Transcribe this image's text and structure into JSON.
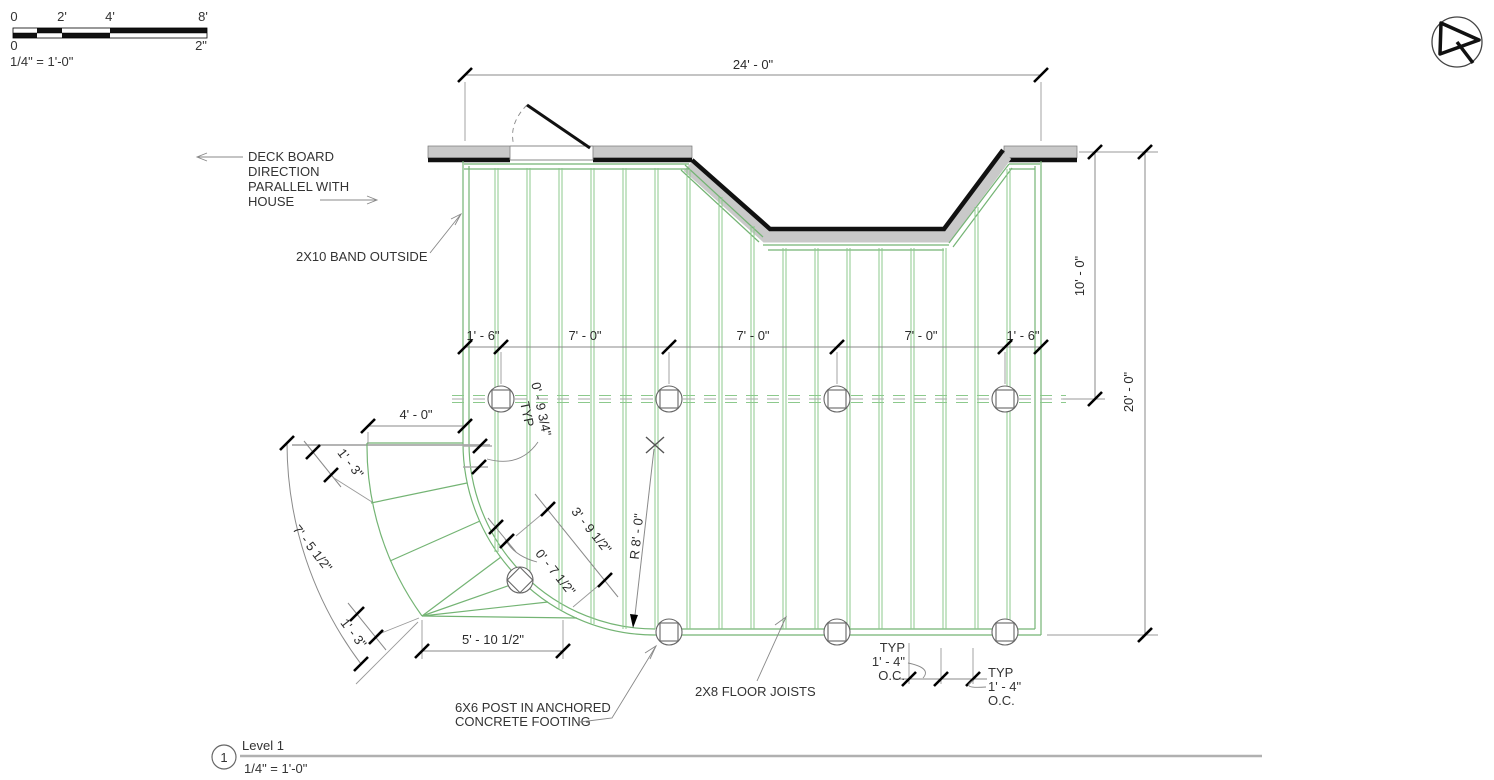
{
  "scale_bar": {
    "ticks_top": [
      "0",
      "2'",
      "4'",
      "8'"
    ],
    "ticks_bottom": [
      "0",
      "2\""
    ],
    "label": "1/4\" = 1'-0\""
  },
  "annotations": {
    "deck_board_lines": [
      "DECK BOARD",
      "DIRECTION",
      "PARALLEL WITH",
      "HOUSE"
    ],
    "band_outside": "2X10 BAND OUTSIDE",
    "post_label_lines": [
      "6X6 POST IN ANCHORED",
      "CONCRETE FOOTING"
    ],
    "floor_joists": "2X8 FLOOR JOISTS",
    "typ_oc_left": [
      "TYP",
      "1' - 4\"",
      "O.C."
    ],
    "typ_oc_right": [
      "TYP",
      "1' - 4\"",
      "O.C."
    ]
  },
  "dimensions": {
    "overall_width": "24' - 0\"",
    "depth_to_beam": "10' - 0\"",
    "overall_depth": "20' - 0\"",
    "post_string": [
      "1' - 6\"",
      "7' - 0\"",
      "7' - 0\"",
      "7' - 0\"",
      "1' - 6\""
    ],
    "stair_top_width": "4' - 0\"",
    "tread_upper": "1' - 3\"",
    "stair_arc": "7' - 5 1/2\"",
    "tread_lower": "1' - 3\"",
    "stair_bottom": "5' - 10 1/2\"",
    "stair_diag": "3' - 9 1/2\"",
    "offset_typ": "0' - 9 3/4\"",
    "offset_typ_suffix": "TYP",
    "tread_offset": "0' - 7 1/2\"",
    "radius": "R 8' - 0\""
  },
  "title": {
    "detail_number": "1",
    "name": "Level 1",
    "scale": "1/4\" = 1'-0\""
  },
  "colors": {
    "joist_green": "#8cc98c",
    "outline_green": "#74b474",
    "band_gray": "#c9c9c9",
    "line_black": "#111111"
  }
}
